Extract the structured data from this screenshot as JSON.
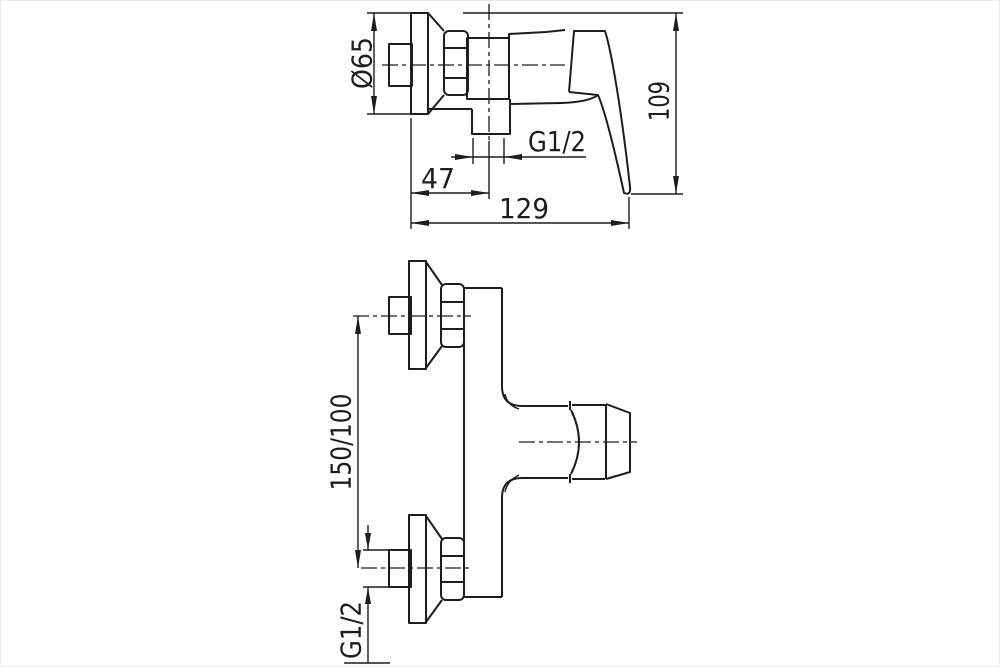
{
  "page": {
    "background": "#ffffff",
    "line_color": "#1d1d1d"
  },
  "drawing": {
    "type": "technical-drawing",
    "subject": "Wall-mounted single-lever shower mixer, two orthographic views with dimensions",
    "side_view": {
      "dimensions": {
        "flange_diameter": "Ø65",
        "overall_height": "109",
        "outlet_thread": "G1/2",
        "outlet_offset_from_wall": "47",
        "overall_depth": "129"
      }
    },
    "top_view": {
      "dimensions": {
        "connection_spacing": "150/100",
        "connection_thread": "G1/2"
      }
    }
  }
}
